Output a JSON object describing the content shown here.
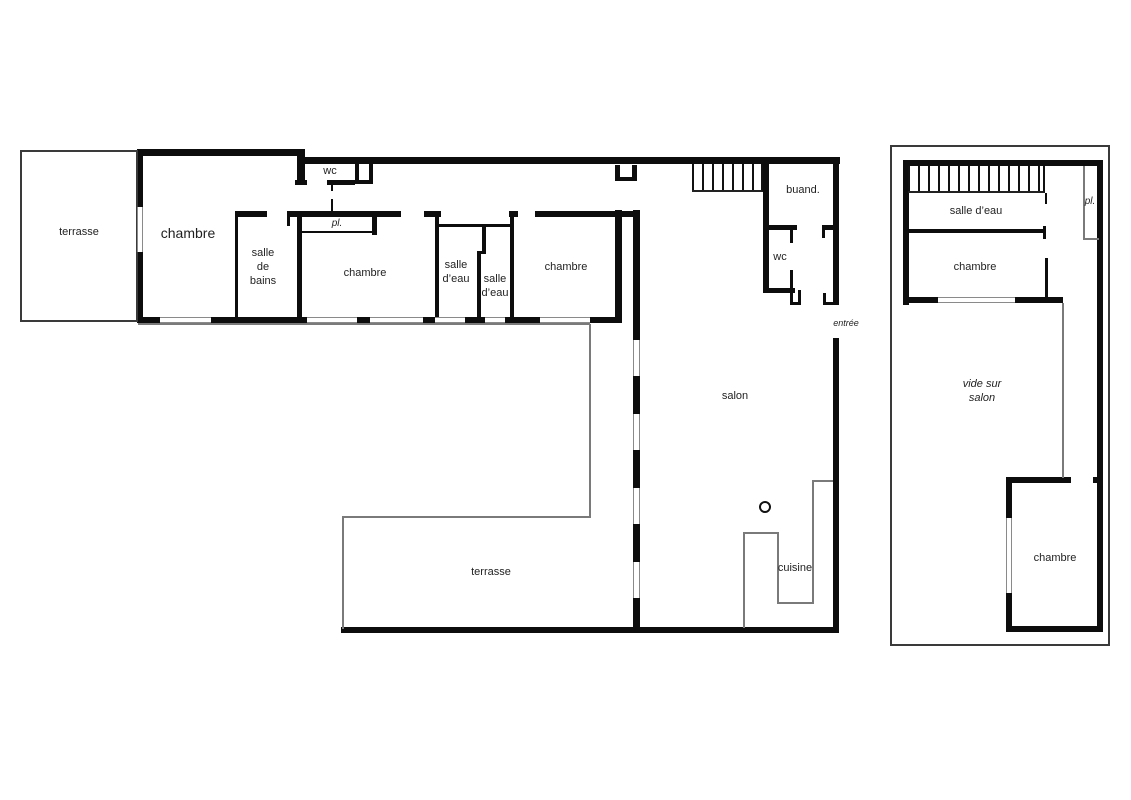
{
  "document": {
    "type": "architectural-floor-plan",
    "language": "fr",
    "colors": {
      "wall": "#0d0d0d",
      "thin_line": "#7a7a7a",
      "text": "#1f1f1f",
      "background": "#ffffff"
    }
  },
  "rooms": {
    "ground_floor": [
      "terrasse",
      "chambre",
      "salle de bains",
      "wc",
      "pl.",
      "chambre",
      "salle d'eau",
      "salle d'eau",
      "chambre",
      "buand.",
      "wc",
      "entrée",
      "salon",
      "cuisine",
      "terrasse"
    ],
    "upper_floor": [
      "salle d'eau",
      "pl.",
      "chambre",
      "vide sur salon",
      "chambre"
    ]
  },
  "labels": [
    {
      "name": "label-terrasse-left",
      "text": "terrasse",
      "x": 79,
      "y": 232,
      "size": 11,
      "italic": false
    },
    {
      "name": "label-chambre-1",
      "text": "chambre",
      "x": 188,
      "y": 233,
      "size": 14,
      "italic": false
    },
    {
      "name": "label-salle-de-bains",
      "text": "salle\nde\nbains",
      "x": 263,
      "y": 267,
      "size": 11,
      "italic": false
    },
    {
      "name": "label-wc-corridor",
      "text": "wc",
      "x": 330,
      "y": 171,
      "size": 11,
      "italic": false
    },
    {
      "name": "label-pl-corridor",
      "text": "pl.",
      "x": 337,
      "y": 224,
      "size": 10,
      "italic": true
    },
    {
      "name": "label-chambre-2",
      "text": "chambre",
      "x": 365,
      "y": 273,
      "size": 11,
      "italic": false
    },
    {
      "name": "label-salle-d-eau-1",
      "text": "salle\nd’eau",
      "x": 456,
      "y": 272,
      "size": 11,
      "italic": false
    },
    {
      "name": "label-salle-d-eau-2",
      "text": "salle\nd’eau",
      "x": 495,
      "y": 286,
      "size": 11,
      "italic": false
    },
    {
      "name": "label-chambre-3",
      "text": "chambre",
      "x": 566,
      "y": 267,
      "size": 11,
      "italic": false
    },
    {
      "name": "label-buanderie",
      "text": "buand.",
      "x": 803,
      "y": 190,
      "size": 11,
      "italic": false
    },
    {
      "name": "label-wc-2",
      "text": "wc",
      "x": 780,
      "y": 257,
      "size": 11,
      "italic": false
    },
    {
      "name": "label-entree",
      "text": "entrée",
      "x": 846,
      "y": 323,
      "size": 9,
      "italic": true
    },
    {
      "name": "label-salon",
      "text": "salon",
      "x": 735,
      "y": 396,
      "size": 11,
      "italic": false
    },
    {
      "name": "label-cuisine",
      "text": "cuisine",
      "x": 795,
      "y": 568,
      "size": 11,
      "italic": false
    },
    {
      "name": "label-terrasse-main",
      "text": "terrasse",
      "x": 491,
      "y": 572,
      "size": 11,
      "italic": false
    },
    {
      "name": "label-salle-d-eau-etage",
      "text": "salle d’eau",
      "x": 976,
      "y": 211,
      "size": 11,
      "italic": false
    },
    {
      "name": "label-pl-etage",
      "text": "pl.",
      "x": 1090,
      "y": 202,
      "size": 10,
      "italic": true
    },
    {
      "name": "label-chambre-etage-1",
      "text": "chambre",
      "x": 975,
      "y": 267,
      "size": 11,
      "italic": false
    },
    {
      "name": "label-vide-sur-salon",
      "text": "vide sur\nsalon",
      "x": 982,
      "y": 391,
      "size": 11,
      "italic": true
    },
    {
      "name": "label-chambre-etage-2",
      "text": "chambre",
      "x": 1055,
      "y": 558,
      "size": 11,
      "italic": false
    }
  ],
  "walls": [
    {
      "name": "wing-top-wall",
      "r": [
        137,
        149,
        168,
        7
      ]
    },
    {
      "name": "wc-left-jamb",
      "r": [
        297,
        149,
        8,
        36
      ]
    },
    {
      "name": "wc-jamb-foot",
      "r": [
        295,
        180,
        12,
        5
      ]
    },
    {
      "name": "corridor-top-wall",
      "r": [
        300,
        157,
        540,
        7
      ]
    },
    {
      "name": "wing-left-wall-upper",
      "r": [
        137,
        149,
        6,
        58
      ]
    },
    {
      "name": "wing-left-wall-lower",
      "r": [
        137,
        252,
        6,
        71
      ]
    },
    {
      "name": "wing-south-wall-1",
      "r": [
        137,
        317,
        23,
        6
      ]
    },
    {
      "name": "wing-south-wall-2",
      "r": [
        211,
        317,
        96,
        6
      ]
    },
    {
      "name": "wing-south-wall-3",
      "r": [
        357,
        317,
        13,
        6
      ]
    },
    {
      "name": "wing-south-wall-4",
      "r": [
        423,
        317,
        12,
        6
      ]
    },
    {
      "name": "wing-south-wall-5",
      "r": [
        465,
        317,
        20,
        6
      ]
    },
    {
      "name": "wing-south-wall-6",
      "r": [
        505,
        317,
        35,
        6
      ]
    },
    {
      "name": "wing-south-wall-7",
      "r": [
        590,
        317,
        32,
        6
      ]
    },
    {
      "name": "wc-bottom-wall",
      "r": [
        327,
        180,
        28,
        5
      ]
    },
    {
      "name": "wc-box-left",
      "r": [
        355,
        162,
        4,
        22
      ]
    },
    {
      "name": "wc-box-right",
      "r": [
        369,
        162,
        4,
        22
      ]
    },
    {
      "name": "wc-box-bottom",
      "r": [
        355,
        180,
        18,
        4
      ]
    },
    {
      "name": "wc-door-tick-1",
      "r": [
        331,
        185,
        2,
        6
      ]
    },
    {
      "name": "wc-door-tick-2",
      "r": [
        331,
        199,
        2,
        13
      ]
    },
    {
      "name": "corridor-south-wall-1",
      "r": [
        287,
        211,
        114,
        6
      ]
    },
    {
      "name": "corridor-south-wall-2",
      "r": [
        424,
        211,
        17,
        6
      ]
    },
    {
      "name": "corridor-south-wall-3",
      "r": [
        509,
        211,
        9,
        6
      ]
    },
    {
      "name": "corridor-south-wall-4",
      "r": [
        535,
        211,
        105,
        6
      ]
    },
    {
      "name": "sdb-top-wall",
      "r": [
        235,
        211,
        32,
        6
      ]
    },
    {
      "name": "sdb-door-jamb",
      "r": [
        287,
        211,
        3,
        15
      ]
    },
    {
      "name": "sdb-left-wall",
      "r": [
        235,
        217,
        3,
        100
      ]
    },
    {
      "name": "sdb-right-wall",
      "r": [
        297,
        211,
        5,
        106
      ]
    },
    {
      "name": "pl-bottom-line",
      "r": [
        300,
        231,
        77,
        2
      ]
    },
    {
      "name": "pl-right-wall",
      "r": [
        372,
        211,
        5,
        24
      ]
    },
    {
      "name": "sde1-left-wall",
      "r": [
        435,
        217,
        4,
        100
      ]
    },
    {
      "name": "sde-header-line",
      "r": [
        437,
        224,
        75,
        3
      ]
    },
    {
      "name": "sde-divider-upper",
      "r": [
        482,
        224,
        4,
        29
      ]
    },
    {
      "name": "sde-divider-jog",
      "r": [
        477,
        251,
        9,
        3
      ]
    },
    {
      "name": "sde-divider-lower",
      "r": [
        477,
        252,
        4,
        65
      ]
    },
    {
      "name": "chambre3-left-wall",
      "r": [
        510,
        211,
        4,
        106
      ]
    },
    {
      "name": "wing-east-wall",
      "r": [
        615,
        210,
        7,
        113
      ]
    },
    {
      "name": "duct-box-left",
      "r": [
        615,
        165,
        5,
        16
      ]
    },
    {
      "name": "duct-box-right",
      "r": [
        632,
        165,
        5,
        16
      ]
    },
    {
      "name": "duct-box-bottom",
      "r": [
        615,
        177,
        22,
        4
      ]
    },
    {
      "name": "salon-west-wall-top",
      "r": [
        633,
        210,
        7,
        130
      ]
    },
    {
      "name": "salon-west-wall-2",
      "r": [
        633,
        376,
        7,
        38
      ]
    },
    {
      "name": "salon-west-wall-3",
      "r": [
        633,
        450,
        7,
        38
      ]
    },
    {
      "name": "salon-west-wall-4",
      "r": [
        633,
        524,
        7,
        38
      ]
    },
    {
      "name": "salon-west-wall-5",
      "r": [
        633,
        598,
        7,
        35
      ]
    },
    {
      "name": "stair-east-wall",
      "r": [
        763,
        157,
        6,
        136
      ]
    },
    {
      "name": "buand-bottom-wall-1",
      "r": [
        765,
        225,
        32,
        5
      ]
    },
    {
      "name": "buand-bottom-wall-2",
      "r": [
        822,
        225,
        17,
        5
      ]
    },
    {
      "name": "buand-door-jamb",
      "r": [
        822,
        230,
        3,
        8
      ]
    },
    {
      "name": "wc2-door-tick-1",
      "r": [
        790,
        230,
        3,
        13
      ]
    },
    {
      "name": "wc2-door-tick-2",
      "r": [
        790,
        270,
        3,
        18
      ]
    },
    {
      "name": "wc2-bottom-wall",
      "r": [
        765,
        288,
        30,
        5
      ]
    },
    {
      "name": "wc2-jamb-left",
      "r": [
        790,
        290,
        3,
        15
      ]
    },
    {
      "name": "wc2-jamb-right",
      "r": [
        798,
        290,
        3,
        15
      ]
    },
    {
      "name": "wc2-jamb-bottom",
      "r": [
        790,
        302,
        11,
        3
      ]
    },
    {
      "name": "east-wall-upper",
      "r": [
        833,
        157,
        6,
        148
      ]
    },
    {
      "name": "entree-jamb-h",
      "r": [
        823,
        302,
        16,
        3
      ]
    },
    {
      "name": "entree-jamb-v",
      "r": [
        823,
        293,
        3,
        12
      ]
    },
    {
      "name": "east-wall-lower",
      "r": [
        833,
        338,
        6,
        295
      ]
    },
    {
      "name": "south-wall-main",
      "r": [
        341,
        627,
        498,
        6
      ]
    },
    {
      "name": "etage-top-wall",
      "r": [
        903,
        160,
        200,
        6
      ]
    },
    {
      "name": "etage-left-wall",
      "r": [
        903,
        160,
        6,
        145
      ]
    },
    {
      "name": "etage-right-wall",
      "r": [
        1097,
        160,
        6,
        472
      ]
    },
    {
      "name": "etage-chambre-south-1",
      "r": [
        903,
        297,
        35,
        6
      ]
    },
    {
      "name": "etage-chambre-south-2",
      "r": [
        1015,
        297,
        48,
        6
      ]
    },
    {
      "name": "etage-sde-bottom-wall",
      "r": [
        903,
        229,
        140,
        4
      ]
    },
    {
      "name": "etage-sde-door-jamb",
      "r": [
        1043,
        226,
        3,
        13
      ]
    },
    {
      "name": "etage-stair-tick",
      "r": [
        1045,
        193,
        2,
        11
      ]
    },
    {
      "name": "etage-chambre-east-wall",
      "r": [
        1045,
        258,
        3,
        44
      ]
    },
    {
      "name": "etage-ch2-top-wall",
      "r": [
        1006,
        477,
        65,
        6
      ]
    },
    {
      "name": "etage-ch2-top-stub",
      "r": [
        1093,
        477,
        10,
        6
      ]
    },
    {
      "name": "etage-ch2-left-upper",
      "r": [
        1006,
        477,
        6,
        41
      ]
    },
    {
      "name": "etage-ch2-left-lower",
      "r": [
        1006,
        593,
        6,
        39
      ]
    },
    {
      "name": "etage-ch2-bottom-wall",
      "r": [
        1006,
        626,
        97,
        6
      ]
    }
  ],
  "thin_lines": [
    {
      "name": "facade-sill-line",
      "r": [
        138,
        323,
        452,
        2
      ]
    },
    {
      "name": "terrace-east-edge",
      "r": [
        589,
        324,
        2,
        193
      ]
    },
    {
      "name": "terrace-step-edge",
      "r": [
        342,
        516,
        249,
        2
      ]
    },
    {
      "name": "terrace-west-edge",
      "r": [
        342,
        516,
        2,
        113
      ]
    },
    {
      "name": "kitchen-counter-v1",
      "r": [
        743,
        532,
        2,
        96
      ]
    },
    {
      "name": "kitchen-counter-h1",
      "r": [
        743,
        532,
        36,
        2
      ]
    },
    {
      "name": "kitchen-counter-v2",
      "r": [
        777,
        532,
        2,
        72
      ]
    },
    {
      "name": "kitchen-counter-h2",
      "r": [
        777,
        602,
        37,
        2
      ]
    },
    {
      "name": "kitchen-counter-v3",
      "r": [
        812,
        480,
        2,
        124
      ]
    },
    {
      "name": "kitchen-counter-h3",
      "r": [
        812,
        480,
        21,
        2
      ]
    },
    {
      "name": "etage-pl-left-line",
      "r": [
        1083,
        166,
        2,
        74
      ]
    },
    {
      "name": "etage-pl-bottom-line",
      "r": [
        1083,
        238,
        16,
        2
      ]
    },
    {
      "name": "etage-void-edge",
      "r": [
        1062,
        303,
        2,
        175
      ]
    }
  ],
  "frames": [
    {
      "name": "terrasse-left-outline",
      "r": [
        20,
        150,
        118,
        172
      ]
    },
    {
      "name": "etage-site-outline",
      "r": [
        890,
        145,
        220,
        501
      ]
    }
  ],
  "windows": [
    {
      "name": "window-wing-south-1",
      "dir": "h",
      "r": [
        160,
        317,
        51,
        6
      ]
    },
    {
      "name": "window-wing-south-2",
      "dir": "h",
      "r": [
        307,
        317,
        50,
        6
      ]
    },
    {
      "name": "window-wing-south-3",
      "dir": "h",
      "r": [
        370,
        317,
        53,
        6
      ]
    },
    {
      "name": "window-wing-south-4",
      "dir": "h",
      "r": [
        435,
        317,
        30,
        6
      ]
    },
    {
      "name": "window-wing-south-5",
      "dir": "h",
      "r": [
        485,
        317,
        20,
        6
      ]
    },
    {
      "name": "window-wing-south-6",
      "dir": "h",
      "r": [
        540,
        317,
        50,
        6
      ]
    },
    {
      "name": "window-chambre1-west",
      "dir": "v",
      "r": [
        137,
        207,
        6,
        45
      ]
    },
    {
      "name": "window-salon-west-1",
      "dir": "v",
      "r": [
        633,
        340,
        7,
        36
      ]
    },
    {
      "name": "window-salon-west-2",
      "dir": "v",
      "r": [
        633,
        414,
        7,
        36
      ]
    },
    {
      "name": "window-salon-west-3",
      "dir": "v",
      "r": [
        633,
        488,
        7,
        36
      ]
    },
    {
      "name": "window-salon-west-4",
      "dir": "v",
      "r": [
        633,
        562,
        7,
        36
      ]
    },
    {
      "name": "window-etage-chambre1",
      "dir": "h",
      "r": [
        938,
        297,
        77,
        6
      ]
    },
    {
      "name": "window-etage-chambre2",
      "dir": "v",
      "r": [
        1006,
        518,
        6,
        75
      ]
    }
  ],
  "stairs": [
    {
      "name": "stairs-ground-floor",
      "r": [
        692,
        164,
        71,
        28
      ]
    },
    {
      "name": "stairs-upper-floor",
      "r": [
        908,
        166,
        137,
        27
      ]
    }
  ],
  "symbols": {
    "column": {
      "name": "salon-column",
      "x": 765,
      "y": 507,
      "r": 6
    }
  }
}
